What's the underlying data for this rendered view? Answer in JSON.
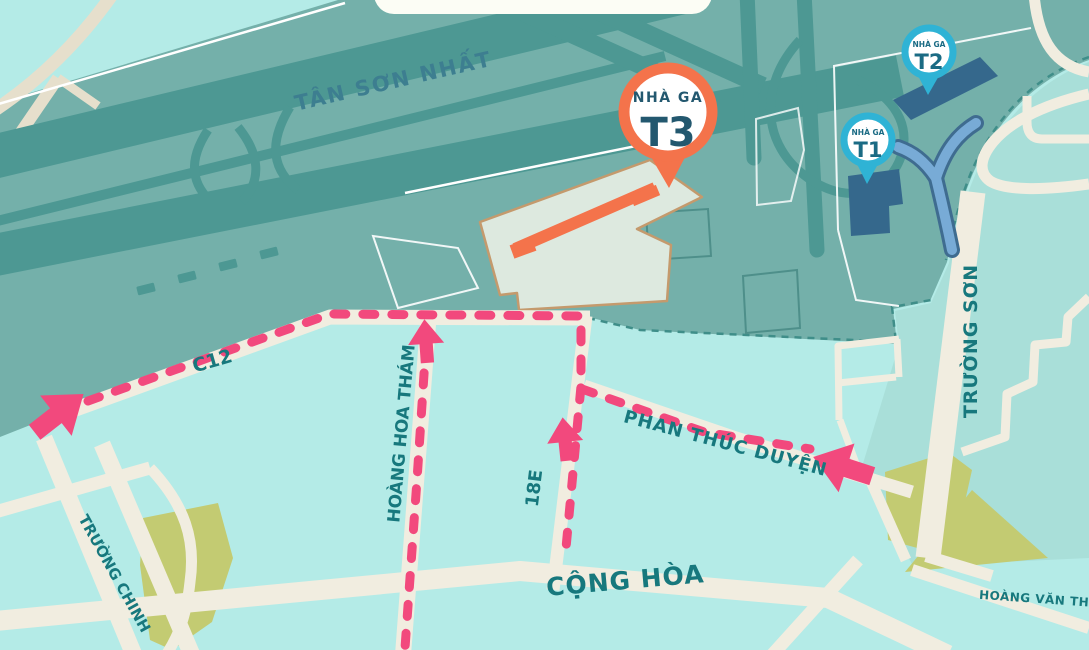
{
  "airport": {
    "name": "TÂN SƠN NHẤT"
  },
  "terminals": {
    "t3": {
      "kicker": "NHÀ GA",
      "code": "T3"
    },
    "t2": {
      "kicker": "NHÀ GA",
      "code": "T2"
    },
    "t1": {
      "kicker": "NHÀ GA",
      "code": "T1"
    }
  },
  "roads": {
    "c12": "C12",
    "hoang_hoa_tham": "HOÀNG HOA THÁM",
    "road_18e": "18E",
    "phan_thuc_duyen": "PHAN THÚC DUYỆN",
    "truong_chinh": "TRƯỜNG CHINH",
    "cong_hoa": "CỘNG HÒA",
    "truong_son": "TRƯỜNG SƠN",
    "hoang_van_thu": "HOÀNG VĂN THỤ"
  },
  "colors": {
    "city": "#b4ebe7",
    "airport_ground": "#74b0aa",
    "runway": "#4d9893",
    "east_area": "#a9dfd9",
    "road": "#f1ede0",
    "road_beige": "#e6dfcc",
    "route_pink": "#f2497d",
    "park": "#c3cb72",
    "terminal_building": "#35688c",
    "ramp": "#78abd6",
    "ramp_edge": "#3f6c90",
    "pin_orange": "#f4734b",
    "pin_blue": "#2fb3d5",
    "label_teal": "#17787d",
    "label_airport": "#3d7e90",
    "pin_text_t3": "#23586f",
    "pin_text_blue": "#1b6b84",
    "plot_fill": "#dde9df",
    "plot_stroke": "#c49a6d",
    "boundary": "#3f8e89",
    "white": "#ffffff",
    "banner": "#fcfdf5"
  }
}
